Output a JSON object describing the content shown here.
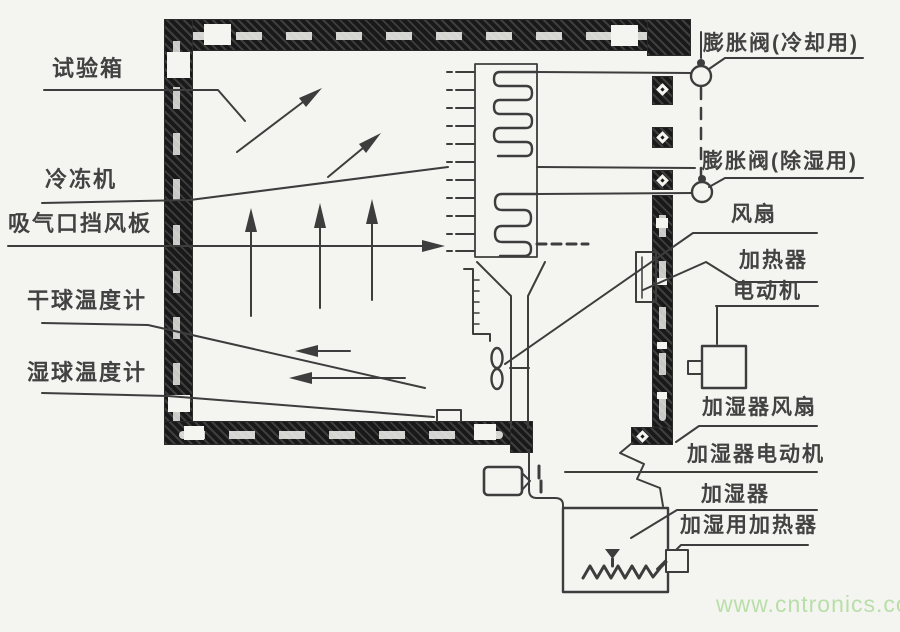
{
  "labels": {
    "test_chamber": "试验箱",
    "refrigerator": "冷冻机",
    "suction_baffle": "吸气口挡风板",
    "dry_bulb_thermometer": "干球温度计",
    "wet_bulb_thermometer": "湿球温度计",
    "expansion_valve_cooling": "膨胀阀(冷却用)",
    "expansion_valve_dehumidify": "膨胀阀(除湿用)",
    "fan": "风扇",
    "heater": "加热器",
    "motor": "电动机",
    "humidifier_fan": "加湿器风扇",
    "humidifier_motor": "加湿器电动机",
    "humidifier": "加湿器",
    "humidifier_heater": "加湿用加热器"
  },
  "watermark": "www.cntronics.com",
  "symbols": {
    "expansion_valve": "circle-with-stem-dot",
    "chamber_wall": "black-hatched-band-with-white-gaps",
    "evaporator_coil": "double-serpentine-in-rectangle",
    "duct_fan": "figure-8-blades",
    "heating_element": "zigzag-line",
    "water_drip": "solid-down-triangle",
    "airflow": "solid-head-arrow"
  },
  "colors": {
    "background": "#f4f4f1",
    "line": "#3d3d3d",
    "wall": "#191919",
    "watermark_green": "#b9dfa9"
  }
}
